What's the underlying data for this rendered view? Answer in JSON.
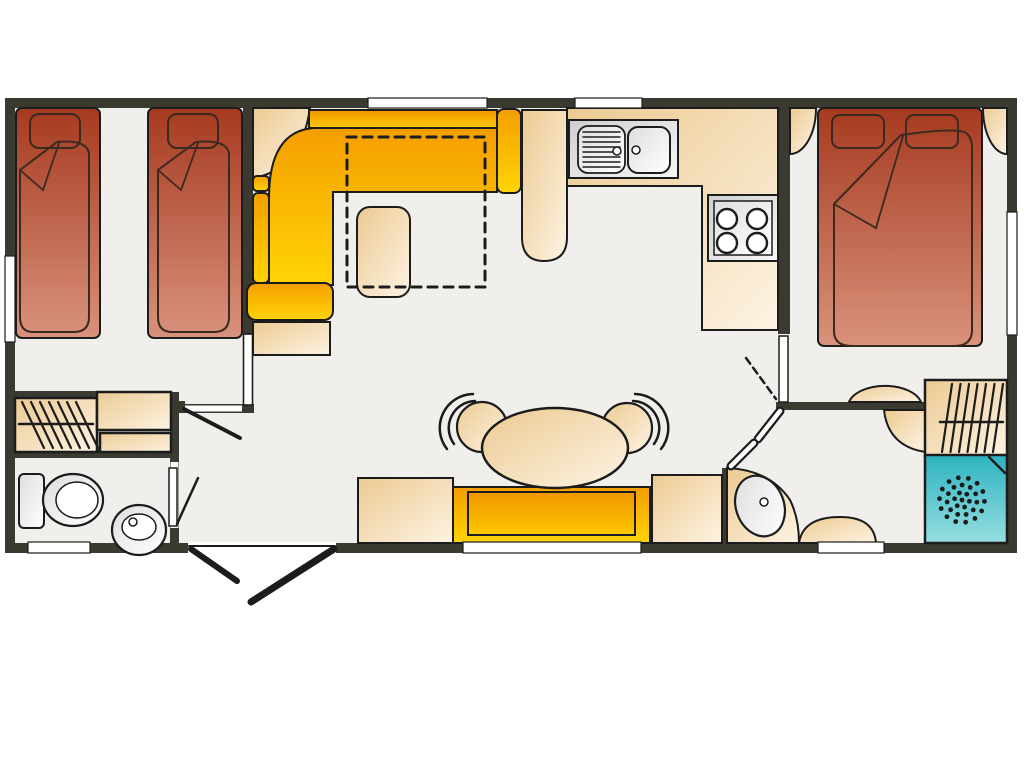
{
  "canvas": {
    "width": 1024,
    "height": 768,
    "background": "#ffffff",
    "label": "static-caravan-floor-plan"
  },
  "colors": {
    "wall": "#3a3a31",
    "floor": "#f0efec",
    "outline": "#1c1c1c",
    "duvet_line": "#3a2a1f",
    "white": "#ffffff",
    "bed_red_dark": "#a63a20",
    "bed_red_light": "#d9927c",
    "sofa_orange": "#f49e00",
    "sofa_yellow": "#ffd405",
    "sofa_back_dark": "#ee9700",
    "sofa_back_light": "#fec800",
    "beige_dark": "#ecca92",
    "beige_light": "#fdf3e3",
    "beige_solid": "#f3d9ab",
    "gray_dark": "#cfcfcf",
    "gray_light": "#f7f7f7",
    "teal_dark": "#2db3c0",
    "teal_light": "#97dee0"
  },
  "rooms": [
    {
      "name": "twin-bedroom"
    },
    {
      "name": "living-area"
    },
    {
      "name": "kitchen"
    },
    {
      "name": "dining-area"
    },
    {
      "name": "hallway"
    },
    {
      "name": "bathroom"
    },
    {
      "name": "double-bedroom"
    },
    {
      "name": "ensuite-shower-room"
    }
  ],
  "elements": [
    {
      "n": "floor",
      "t": "rect",
      "x": 10,
      "y": 103,
      "w": 1002,
      "h": 445,
      "f": "floor"
    },
    {
      "n": "exterior-wall",
      "t": "rect",
      "x": 10,
      "y": 103,
      "w": 1002,
      "h": 445,
      "f": "none",
      "s": "k2",
      "sw": 10
    },
    {
      "n": "wall-twin-bedroom",
      "t": "rect",
      "x": 243,
      "y": 98,
      "w": 10,
      "h": 236,
      "f": "wallc"
    },
    {
      "n": "wall-hallway",
      "t": "rect",
      "x": 170,
      "y": 404,
      "w": 84,
      "h": 9,
      "f": "wallc"
    },
    {
      "n": "wall-bathroom-top",
      "t": "rect",
      "x": 5,
      "y": 391,
      "w": 92,
      "h": 8,
      "f": "wallc"
    },
    {
      "n": "wall-bathroom-right",
      "t": "rect",
      "x": 170,
      "y": 392,
      "w": 9,
      "h": 160,
      "f": "wallc"
    },
    {
      "n": "wall-bathroom-mid",
      "t": "rect",
      "x": 5,
      "y": 449,
      "w": 174,
      "h": 9,
      "f": "wallc"
    },
    {
      "n": "wall-kitchen-bedroom",
      "t": "rect",
      "x": 778,
      "y": 98,
      "w": 12,
      "h": 236,
      "f": "wallc"
    },
    {
      "n": "wall-ensuite-top",
      "t": "rect",
      "x": 776,
      "y": 402,
      "w": 150,
      "h": 8,
      "f": "wallc"
    },
    {
      "n": "wall-ensuite-left",
      "t": "rect",
      "x": 722,
      "y": 468,
      "w": 8,
      "h": 84,
      "f": "wallc"
    },
    {
      "n": "twin-bed-1",
      "t": "rect",
      "x": 16,
      "y": 108,
      "w": 84,
      "h": 230,
      "rx": 6,
      "f": "red",
      "s": "k",
      "sw": 2
    },
    {
      "n": "twin-bed-1-pillow",
      "t": "rect",
      "x": 30,
      "y": 114,
      "w": 50,
      "h": 34,
      "rx": 9,
      "f": "none",
      "s": "dk",
      "sw": 2
    },
    {
      "n": "twin-bed-1-duvet",
      "t": "path",
      "d": "M20,170 L57,142 Q86,139 89,153 L89,317 Q89,332 74,332 L33,332 Q20,332 20,317 Z",
      "f": "none",
      "s": "dk",
      "sw": 2
    },
    {
      "n": "twin-bed-1-duvet-fold",
      "t": "path",
      "d": "M20,170 L43,190 L59,143",
      "f": "none",
      "s": "dk",
      "sw": 1.8
    },
    {
      "n": "twin-bed-2",
      "t": "rect",
      "x": 148,
      "y": 108,
      "w": 94,
      "h": 230,
      "rx": 6,
      "f": "red",
      "s": "k",
      "sw": 2
    },
    {
      "n": "twin-bed-2-pillow",
      "t": "rect",
      "x": 168,
      "y": 114,
      "w": 50,
      "h": 34,
      "rx": 9,
      "f": "none",
      "s": "dk",
      "sw": 2
    },
    {
      "n": "twin-bed-2-duvet",
      "t": "path",
      "d": "M158,170 L196,142 Q226,139 229,153 L229,317 Q229,332 214,332 L172,332 Q158,332 158,317 Z",
      "f": "none",
      "s": "dk",
      "sw": 2
    },
    {
      "n": "twin-bed-2-duvet-fold",
      "t": "path",
      "d": "M158,170 L181,190 L198,143",
      "f": "none",
      "s": "dk",
      "sw": 1.8
    },
    {
      "n": "wardrobe-bathroom",
      "t": "rect",
      "x": 15,
      "y": 398,
      "w": 82,
      "h": 54,
      "f": "beige",
      "s": "k",
      "sw": 2.5
    },
    {
      "n": "wardrobe-bathroom-hangers",
      "t": "mline",
      "x1": 22,
      "y1": 402,
      "x2": 44,
      "y2": 448,
      "ln": 7,
      "ox": 9,
      "oy": 0,
      "s": "k",
      "sw": 2.2
    },
    {
      "n": "wardrobe-bathroom-rail",
      "t": "line",
      "x1": 19,
      "y1": 424,
      "x2": 93,
      "y2": 424,
      "s": "k",
      "sw": 2.5
    },
    {
      "n": "bathroom-cabinet-upper",
      "t": "rect",
      "x": 97,
      "y": 392,
      "w": 74,
      "h": 38,
      "f": "beige",
      "s": "k",
      "sw": 2.5
    },
    {
      "n": "bathroom-cabinet-lower",
      "t": "rect",
      "x": 100,
      "y": 433,
      "w": 71,
      "h": 19,
      "f": "beige",
      "s": "k",
      "sw": 2.5
    },
    {
      "n": "toilet-cistern",
      "t": "rect",
      "x": 19,
      "y": 474,
      "w": 25,
      "h": 54,
      "rx": 5,
      "f": "grayL",
      "s": "k",
      "sw": 2
    },
    {
      "n": "toilet-bowl",
      "t": "ell",
      "cx": 73,
      "cy": 500,
      "rx": 30,
      "ry": 26,
      "f": "grayL",
      "s": "k",
      "sw": 2.2
    },
    {
      "n": "toilet-bowl-inner",
      "t": "ell",
      "cx": 77,
      "cy": 500,
      "rx": 21,
      "ry": 18,
      "f": "white",
      "s": "k",
      "sw": 1.5
    },
    {
      "n": "basin-pedestal",
      "t": "ell",
      "cx": 139,
      "cy": 530,
      "rx": 27,
      "ry": 25,
      "f": "grayL",
      "s": "k",
      "sw": 2.2
    },
    {
      "n": "basin-bowl",
      "t": "ell",
      "cx": 139,
      "cy": 527,
      "rx": 17,
      "ry": 13,
      "f": "white",
      "s": "k",
      "sw": 1.5
    },
    {
      "n": "basin-tap",
      "t": "ell",
      "cx": 133,
      "cy": 522,
      "rx": 4,
      "ry": 4,
      "f": "white",
      "s": "k",
      "sw": 1.5
    },
    {
      "n": "corner-shelf",
      "t": "path",
      "d": "M253,108 L253,178 Q301,170 310,108 Z",
      "f": "beige",
      "s": "k",
      "sw": 2
    },
    {
      "n": "sofa-back-top",
      "t": "rect",
      "x": 309,
      "y": 110,
      "w": 188,
      "h": 18,
      "f": "orange",
      "s": "k",
      "sw": 2
    },
    {
      "n": "sofa-right-arm",
      "t": "rect",
      "x": 497,
      "y": 109,
      "w": 24,
      "h": 84,
      "rx": 7,
      "f": "yellow",
      "s": "k",
      "sw": 2
    },
    {
      "n": "sofa-seats",
      "t": "path",
      "d": "M269,285 L269,198 Q269,131 314,128 L497,128 L497,192 L333,192 L333,285 Z",
      "f": "yellow",
      "s": "k",
      "sw": 2
    },
    {
      "n": "sofa-back-left-1",
      "t": "rect",
      "x": 253,
      "y": 176,
      "w": 16,
      "h": 15,
      "rx": 4,
      "f": "yellow",
      "s": "k",
      "sw": 2
    },
    {
      "n": "sofa-back-left-2",
      "t": "rect",
      "x": 253,
      "y": 193,
      "w": 16,
      "h": 90,
      "rx": 5,
      "f": "yellow",
      "s": "k",
      "sw": 2
    },
    {
      "n": "sofa-bottom-arm",
      "t": "rect",
      "x": 247,
      "y": 283,
      "w": 86,
      "h": 37,
      "rx": 9,
      "f": "yellow",
      "s": "k",
      "sw": 2
    },
    {
      "n": "sofa-end-table",
      "t": "rect",
      "x": 253,
      "y": 322,
      "w": 77,
      "h": 33,
      "f": "beige",
      "s": "k",
      "sw": 2
    },
    {
      "n": "coffee-stool",
      "t": "rect",
      "x": 357,
      "y": 207,
      "w": 53,
      "h": 90,
      "rx": 13,
      "f": "beige",
      "s": "k",
      "sw": 2
    },
    {
      "n": "sofa-bed-outline",
      "t": "rect",
      "x": 347,
      "y": 137,
      "w": 138,
      "h": 150,
      "f": "none",
      "s": "k",
      "sw": 3,
      "dash": "9 7"
    },
    {
      "n": "breakfast-bar",
      "t": "path",
      "d": "M522,110 L567,110 L567,237 Q567,261 544,261 Q522,261 522,237 Z",
      "f": "beige",
      "s": "k",
      "sw": 2
    },
    {
      "n": "kitchen-counter",
      "t": "path",
      "d": "M567,108 L778,108 L778,330 L702,330 L702,186 L567,186 Z",
      "f": "beige",
      "s": "k",
      "sw": 2
    },
    {
      "n": "sink-unit",
      "t": "rect",
      "x": 569,
      "y": 120,
      "w": 109,
      "h": 58,
      "f": "gray",
      "s": "k",
      "sw": 2
    },
    {
      "n": "sink-drainer",
      "t": "rect",
      "x": 578,
      "y": 126,
      "w": 47,
      "h": 47,
      "rx": 10,
      "f": "grayL",
      "s": "k",
      "sw": 1.8
    },
    {
      "n": "sink-drainer-ridges",
      "t": "mline",
      "x1": 583,
      "y1": 132,
      "x2": 620,
      "y2": 132,
      "ln": 8,
      "ox": 0,
      "oy": 5,
      "s": "k",
      "sw": 1.4
    },
    {
      "n": "sink-drainer-tap",
      "t": "ell",
      "cx": 617,
      "cy": 151,
      "rx": 4,
      "ry": 4,
      "f": "white",
      "s": "k",
      "sw": 1.5
    },
    {
      "n": "sink-basin",
      "t": "rect",
      "x": 628,
      "y": 127,
      "w": 42,
      "h": 46,
      "rx": 10,
      "f": "grayL",
      "s": "k",
      "sw": 2
    },
    {
      "n": "sink-basin-tap",
      "t": "ell",
      "cx": 636,
      "cy": 150,
      "rx": 4,
      "ry": 4,
      "f": "white",
      "s": "k",
      "sw": 1.5
    },
    {
      "n": "hob-unit",
      "t": "rect",
      "x": 708,
      "y": 195,
      "w": 70,
      "h": 66,
      "f": "gray",
      "s": "k",
      "sw": 2
    },
    {
      "n": "hob-top",
      "t": "rect",
      "x": 714,
      "y": 201,
      "w": 58,
      "h": 54,
      "f": "grayL",
      "s": "k",
      "sw": 1.5
    },
    {
      "n": "hob-burner-1",
      "t": "ell",
      "cx": 727,
      "cy": 219,
      "rx": 10,
      "ry": 10,
      "f": "white",
      "s": "k",
      "sw": 2.4
    },
    {
      "n": "hob-burner-2",
      "t": "ell",
      "cx": 757,
      "cy": 219,
      "rx": 10,
      "ry": 10,
      "f": "white",
      "s": "k",
      "sw": 2.4
    },
    {
      "n": "hob-burner-3",
      "t": "ell",
      "cx": 727,
      "cy": 243,
      "rx": 10,
      "ry": 10,
      "f": "white",
      "s": "k",
      "sw": 2.4
    },
    {
      "n": "hob-burner-4",
      "t": "ell",
      "cx": 757,
      "cy": 243,
      "rx": 10,
      "ry": 10,
      "f": "white",
      "s": "k",
      "sw": 2.4
    },
    {
      "n": "bedside-unit-left",
      "t": "path",
      "d": "M790,108 L816,108 A26,46 0 0 1 790,154 Z",
      "f": "beige",
      "s": "k",
      "sw": 2
    },
    {
      "n": "bedside-unit-right",
      "t": "path",
      "d": "M1007,108 L983,108 A24,46 0 0 0 1007,154 Z",
      "f": "beige",
      "s": "k",
      "sw": 2
    },
    {
      "n": "double-bed",
      "t": "rect",
      "x": 818,
      "y": 108,
      "w": 164,
      "h": 238,
      "rx": 6,
      "f": "red",
      "s": "k",
      "sw": 2
    },
    {
      "n": "double-bed-pillow-1",
      "t": "rect",
      "x": 832,
      "y": 115,
      "w": 52,
      "h": 33,
      "rx": 8,
      "f": "none",
      "s": "dk",
      "sw": 2
    },
    {
      "n": "double-bed-pillow-2",
      "t": "rect",
      "x": 906,
      "y": 115,
      "w": 52,
      "h": 33,
      "rx": 8,
      "f": "none",
      "s": "dk",
      "sw": 2
    },
    {
      "n": "double-bed-duvet",
      "t": "path",
      "d": "M834,204 L901,135 Q958,127 966,133 Q973,138 972,152 L972,330 Q972,346 954,346 L852,346 Q834,346 834,331 Z",
      "f": "none",
      "s": "dk",
      "sw": 2
    },
    {
      "n": "double-bed-duvet-fold",
      "t": "path",
      "d": "M834,204 L876,228 L903,136",
      "f": "none",
      "s": "dk",
      "sw": 1.8
    },
    {
      "n": "dressing-table",
      "t": "path",
      "d": "M849,402 A37,21 0 0 1 921,402 Z",
      "f": "beige",
      "s": "k",
      "sw": 2
    },
    {
      "n": "ensuite-corner-unit",
      "t": "path",
      "d": "M884,410 L925,410 L925,452 Q888,446 884,410 Z",
      "f": "beige",
      "s": "k",
      "sw": 2
    },
    {
      "n": "wardrobe-ensuite",
      "t": "rect",
      "x": 925,
      "y": 380,
      "w": 82,
      "h": 77,
      "f": "beige",
      "s": "k",
      "sw": 2.5
    },
    {
      "n": "wardrobe-ensuite-hangers",
      "t": "mline",
      "x1": 952,
      "y1": 384,
      "x2": 942,
      "y2": 452,
      "ln": 7,
      "ox": 8.5,
      "oy": 0,
      "s": "k",
      "sw": 2.2
    },
    {
      "n": "wardrobe-ensuite-rail",
      "t": "line",
      "x1": 940,
      "y1": 422,
      "x2": 1003,
      "y2": 422,
      "s": "k",
      "sw": 2.5
    },
    {
      "n": "shower",
      "t": "rect",
      "x": 925,
      "y": 455,
      "w": 82,
      "h": 88,
      "f": "teal",
      "s": "k",
      "sw": 2.5
    },
    {
      "n": "shower-corner",
      "t": "line",
      "x1": 989,
      "y1": 457,
      "x2": 1005,
      "y2": 473,
      "s": "k",
      "sw": 2.5
    },
    {
      "n": "shower-drain-dots",
      "t": "dots",
      "cx": 962,
      "cy": 500,
      "rings": [
        [
          0,
          1
        ],
        [
          7.5,
          6
        ],
        [
          15,
          11
        ],
        [
          22.5,
          14
        ]
      ],
      "dr": 2.4,
      "f": "k"
    },
    {
      "n": "vanity-ensuite",
      "t": "path",
      "d": "M727,468 Q770,470 790,500 Q799,518 799,543 L727,543 Z",
      "f": "beige",
      "s": "k",
      "sw": 2
    },
    {
      "n": "vanity-basin",
      "t": "ell",
      "cx": 760,
      "cy": 506,
      "rx": 24,
      "ry": 31,
      "rot": -20,
      "f": "grayL",
      "s": "k",
      "sw": 2.2
    },
    {
      "n": "vanity-tap",
      "t": "ell",
      "cx": 764,
      "cy": 502,
      "rx": 4,
      "ry": 4,
      "f": "white",
      "s": "k",
      "sw": 1.5
    },
    {
      "n": "ensuite-corner-seat",
      "t": "path",
      "d": "M799,543 Q803,517 840,517 Q874,517 876,543 Z",
      "f": "beige",
      "s": "k",
      "sw": 2
    },
    {
      "n": "dining-cabinet-left",
      "t": "rect",
      "x": 358,
      "y": 478,
      "w": 95,
      "h": 65,
      "f": "beige",
      "s": "k",
      "sw": 2
    },
    {
      "n": "dining-cabinet-right",
      "t": "rect",
      "x": 652,
      "y": 475,
      "w": 70,
      "h": 68,
      "f": "beige",
      "s": "k",
      "sw": 2
    },
    {
      "n": "dining-bench",
      "t": "rect",
      "x": 453,
      "y": 487,
      "w": 197,
      "h": 56,
      "f": "yellow",
      "s": "k",
      "sw": 2
    },
    {
      "n": "dining-bench-cushion",
      "t": "rect",
      "x": 468,
      "y": 492,
      "w": 167,
      "h": 43,
      "f": "orange",
      "s": "k",
      "sw": 2
    },
    {
      "n": "chair-left-back-outer",
      "t": "path",
      "d": "M447,449 A34,34 0 0 1 473,394",
      "f": "none",
      "s": "k",
      "sw": 2.5
    },
    {
      "n": "chair-left-back-inner",
      "t": "path",
      "d": "M454,444 A27,27 0 0 1 475,401",
      "f": "none",
      "s": "k",
      "sw": 2.5
    },
    {
      "n": "chair-left",
      "t": "ell",
      "cx": 482,
      "cy": 427,
      "rx": 25,
      "ry": 25,
      "f": "beige",
      "s": "k",
      "sw": 2.2
    },
    {
      "n": "chair-right-back-outer",
      "t": "path",
      "d": "M635,394 A34,34 0 0 1 661,449",
      "f": "none",
      "s": "k",
      "sw": 2.5
    },
    {
      "n": "chair-right-back-inner",
      "t": "path",
      "d": "M633,401 A27,27 0 0 1 654,444",
      "f": "none",
      "s": "k",
      "sw": 2.5
    },
    {
      "n": "chair-right",
      "t": "ell",
      "cx": 627,
      "cy": 428,
      "rx": 25,
      "ry": 25,
      "f": "beige",
      "s": "k",
      "sw": 2.2
    },
    {
      "n": "dining-table",
      "t": "ell",
      "cx": 555,
      "cy": 448,
      "rx": 73,
      "ry": 40,
      "f": "beige",
      "s": "k",
      "sw": 2.5
    },
    {
      "n": "window-top-living",
      "t": "rect",
      "x": 368,
      "y": 98,
      "w": 119,
      "h": 10,
      "f": "white",
      "s": "k",
      "sw": 1.2
    },
    {
      "n": "window-top-kitchen",
      "t": "rect",
      "x": 575,
      "y": 98,
      "w": 67,
      "h": 10,
      "f": "white",
      "s": "k",
      "sw": 1.2
    },
    {
      "n": "window-left-twin-bedroom",
      "t": "rect",
      "x": 5,
      "y": 256,
      "w": 10,
      "h": 86,
      "f": "white",
      "s": "k",
      "sw": 1.2
    },
    {
      "n": "window-right-double-bedroom",
      "t": "rect",
      "x": 1007,
      "y": 212,
      "w": 10,
      "h": 123,
      "f": "white",
      "s": "k",
      "sw": 1.2
    },
    {
      "n": "window-bottom-bathroom",
      "t": "rect",
      "x": 28,
      "y": 542,
      "w": 62,
      "h": 11,
      "f": "white",
      "s": "k",
      "sw": 1.2
    },
    {
      "n": "window-bottom-dining",
      "t": "rect",
      "x": 463,
      "y": 542,
      "w": 178,
      "h": 11,
      "f": "white",
      "s": "k",
      "sw": 1.2
    },
    {
      "n": "window-bottom-ensuite",
      "t": "rect",
      "x": 818,
      "y": 542,
      "w": 66,
      "h": 11,
      "f": "white",
      "s": "k",
      "sw": 1.2
    },
    {
      "n": "entrance-opening",
      "t": "rect",
      "x": 188,
      "y": 542,
      "w": 148,
      "h": 11,
      "f": "white"
    },
    {
      "n": "entrance-frame",
      "t": "line",
      "x1": 189,
      "y1": 546,
      "x2": 335,
      "y2": 546,
      "s": "k",
      "sw": 2
    },
    {
      "n": "entrance-door-left-leaf",
      "t": "line",
      "x1": 191,
      "y1": 549,
      "x2": 237,
      "y2": 581,
      "s": "k",
      "sw": 6
    },
    {
      "n": "entrance-door-right-leaf",
      "t": "line",
      "x1": 334,
      "y1": 549,
      "x2": 251,
      "y2": 602,
      "s": "k",
      "sw": 7
    },
    {
      "n": "twin-door-opening",
      "t": "rect",
      "x": 184,
      "y": 405.5,
      "w": 58,
      "h": 6,
      "f": "white"
    },
    {
      "n": "twin-door-hinge",
      "t": "rect",
      "x": 175,
      "y": 401,
      "w": 10,
      "h": 12,
      "f": "wallc"
    },
    {
      "n": "twin-door-leaf",
      "t": "line",
      "x1": 184,
      "y1": 409,
      "x2": 240,
      "y2": 438,
      "s": "k",
      "sw": 4
    },
    {
      "n": "twin-pocket-door",
      "t": "rect",
      "x": 243.5,
      "y": 334,
      "w": 9,
      "h": 71,
      "f": "white",
      "s": "k",
      "sw": 1.6
    },
    {
      "n": "bathroom-door-opening",
      "t": "rect",
      "x": 170.5,
      "y": 462,
      "w": 8,
      "h": 66,
      "f": "white"
    },
    {
      "n": "bathroom-door-leaf",
      "t": "rect",
      "x": 169,
      "y": 468,
      "w": 8,
      "h": 58,
      "f": "white",
      "s": "k",
      "sw": 1.5
    },
    {
      "n": "bathroom-door-swing",
      "t": "line",
      "x1": 177,
      "y1": 524,
      "x2": 198,
      "y2": 478,
      "s": "k",
      "sw": 2.5
    },
    {
      "n": "bedroom-door-leaf",
      "t": "rect",
      "x": 779,
      "y": 336,
      "w": 9,
      "h": 66,
      "f": "white",
      "s": "k",
      "sw": 1.5
    },
    {
      "n": "bedroom-door-swing",
      "t": "line",
      "x1": 746,
      "y1": 358,
      "x2": 776,
      "y2": 399,
      "s": "k",
      "sw": 2.5,
      "dash": "7 5"
    },
    {
      "n": "ensuite-bifold-door-1-outline",
      "t": "line",
      "x1": 780,
      "y1": 411,
      "x2": 758,
      "y2": 439,
      "s": "k",
      "sw": 9
    },
    {
      "n": "ensuite-bifold-door-1",
      "t": "line",
      "x1": 780,
      "y1": 411,
      "x2": 758,
      "y2": 439,
      "s": "w",
      "sw": 4.5
    },
    {
      "n": "ensuite-bifold-door-2-outline",
      "t": "line",
      "x1": 754,
      "y1": 443,
      "x2": 731,
      "y2": 466,
      "s": "k",
      "sw": 9
    },
    {
      "n": "ensuite-bifold-door-2",
      "t": "line",
      "x1": 754,
      "y1": 443,
      "x2": 731,
      "y2": 466,
      "s": "w",
      "sw": 4.5
    }
  ]
}
